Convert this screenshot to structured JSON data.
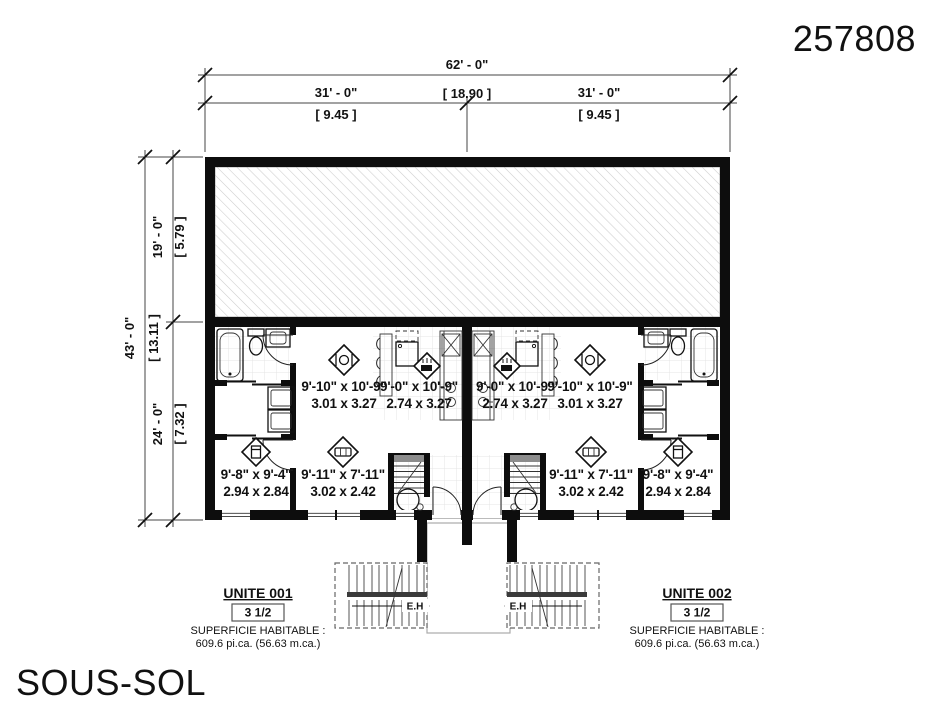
{
  "drawing_number": "257808",
  "floor_label": "SOUS-SOL",
  "dimensions": {
    "overall_width": {
      "ft": "62' - 0\"",
      "m": "[ 18.90 ]"
    },
    "left_width": {
      "ft": "31' - 0\"",
      "m": "[ 9.45 ]"
    },
    "right_width": {
      "ft": "31' - 0\"",
      "m": "[ 9.45 ]"
    },
    "overall_depth": {
      "ft": "43' - 0\"",
      "m": "[ 13.11 ]"
    },
    "top_depth": {
      "ft": "19' - 0\"",
      "m": "[ 5.79 ]"
    },
    "bottom_depth": {
      "ft": "24' - 0\"",
      "m": "[ 7.32 ]"
    }
  },
  "rooms": {
    "dining": {
      "imperial": "9'-10\" x 10'-9\"",
      "metric": "3.01 x 3.27"
    },
    "kitchen": {
      "imperial": "9'-0\" x 10'-9\"",
      "metric": "2.74 x 3.27"
    },
    "bedroom": {
      "imperial": "9'-8\" x 9'-4\"",
      "metric": "2.94 x 2.84"
    },
    "living": {
      "imperial": "9'-11\" x 7'-11\"",
      "metric": "3.02 x 2.42"
    }
  },
  "units": [
    {
      "name": "UNITE 001",
      "type": "3 1/2",
      "area_title": "SUPERFICIE HABITABLE :",
      "area_value": "609.6 pi.ca. (56.63 m.ca.)"
    },
    {
      "name": "UNITE 002",
      "type": "3 1/2",
      "area_title": "SUPERFICIE HABITABLE :",
      "area_value": "609.6 pi.ca. (56.63 m.ca.)"
    }
  ],
  "stair_labels": {
    "left": "E.H",
    "right": "E.H"
  }
}
